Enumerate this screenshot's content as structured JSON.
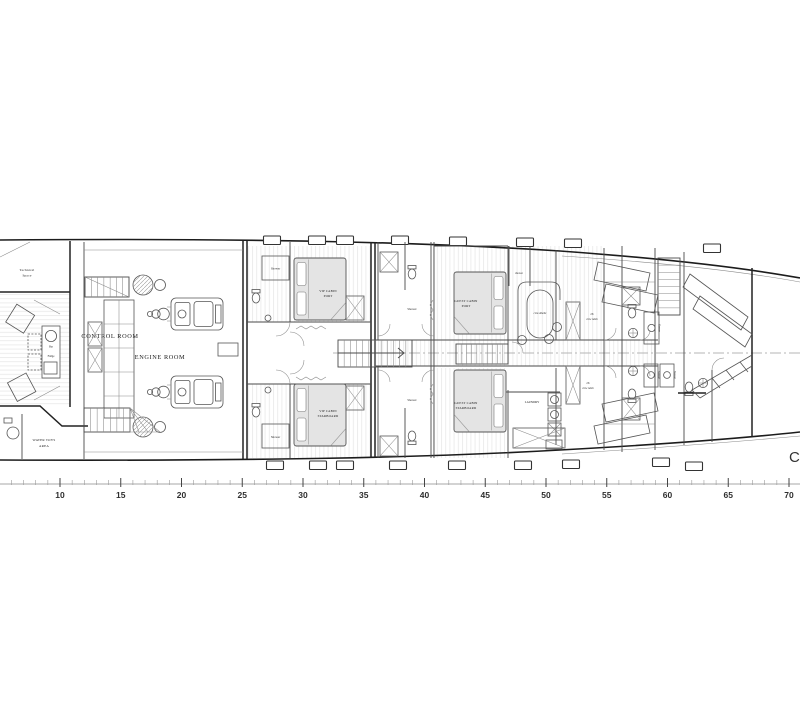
{
  "labels": {
    "technical_space": {
      "line1": "Technical",
      "line2": "Space"
    },
    "control_room": "CONTROL ROOM",
    "engine_room": "ENGINE ROOM",
    "water_toys_area": {
      "line1": "WATER TOYS",
      "line2": "AREA"
    },
    "bar": "Bar",
    "fridge": "Fridge",
    "shower": "Shower",
    "shower_lowercase": "shower",
    "vip_cabin_port": {
      "line1": "VIP CABIN",
      "line2": "PORT"
    },
    "vip_cabin_starboard": {
      "line1": "VIP CABIN",
      "line2": "STARBOARD"
    },
    "guest_cabin_port": {
      "line1": "GUEST CABIN",
      "line2": "PORT"
    },
    "guest_cabin_starboard": {
      "line1": "GUEST CABIN",
      "line2": "STARBOARD"
    },
    "crew_dinette": "crew dinette",
    "crew_cabin": {
      "line1": "2X",
      "line2": "crew cabin"
    },
    "laundry": "LAUNDRY",
    "bow_letter": "C"
  },
  "ruler": {
    "unit_labels": [
      "10",
      "15",
      "20",
      "25",
      "30",
      "35",
      "40",
      "45",
      "50",
      "55",
      "60",
      "65",
      "70"
    ]
  },
  "colors": {
    "line_dark": "#1c1c1c",
    "line_mid": "#555555",
    "line_light": "#9a9a9a",
    "bed_fill": "#e4e4e4",
    "centerline": "#b5b5b5",
    "paper": "#ffffff"
  }
}
